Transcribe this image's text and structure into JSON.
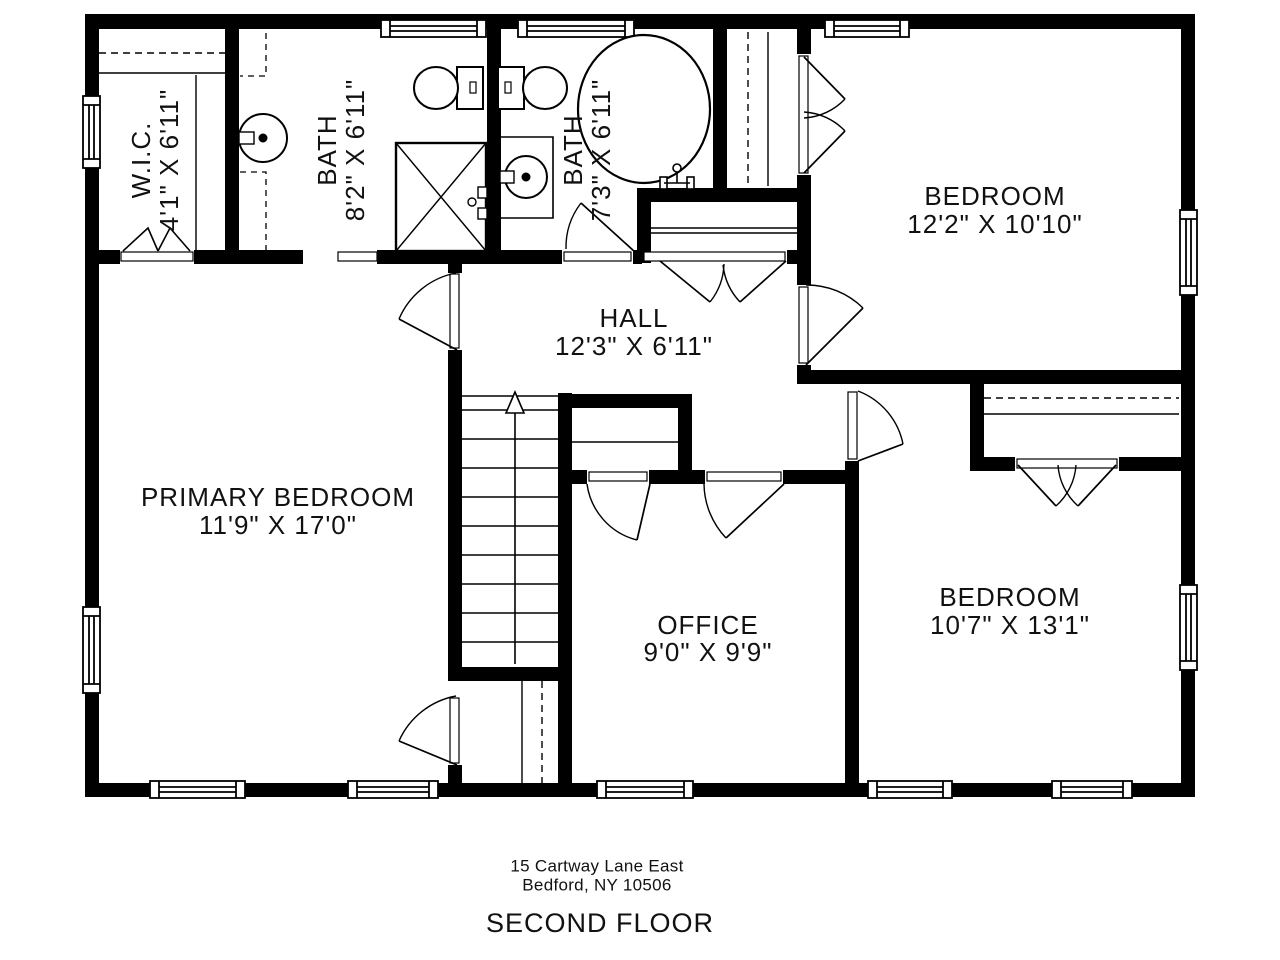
{
  "plan": {
    "title": "SECOND FLOOR",
    "address": {
      "line1": "15 Cartway Lane East",
      "line2": "Bedford, NY  10506"
    },
    "rooms": {
      "wic": {
        "name": "W.I.C.",
        "dims": "4'1\" X 6'11\""
      },
      "bath1": {
        "name": "BATH",
        "dims": "8'2\" X 6'11\""
      },
      "bath2": {
        "name": "BATH",
        "dims": "7'3\" X 6'11\""
      },
      "bedroom1": {
        "name": "BEDROOM",
        "dims": "12'2\" X 10'10\""
      },
      "hall": {
        "name": "HALL",
        "dims": "12'3\" X 6'11\""
      },
      "primary": {
        "name": "PRIMARY BEDROOM",
        "dims": "11'9\" X 17'0\""
      },
      "office": {
        "name": "OFFICE",
        "dims": "9'0\" X 9'9\""
      },
      "bedroom2": {
        "name": "BEDROOM",
        "dims": "10'7\" X 13'1\""
      }
    },
    "colors": {
      "wall": "#000000",
      "line": "#000000",
      "text": "#111111",
      "bg": "#ffffff"
    }
  }
}
